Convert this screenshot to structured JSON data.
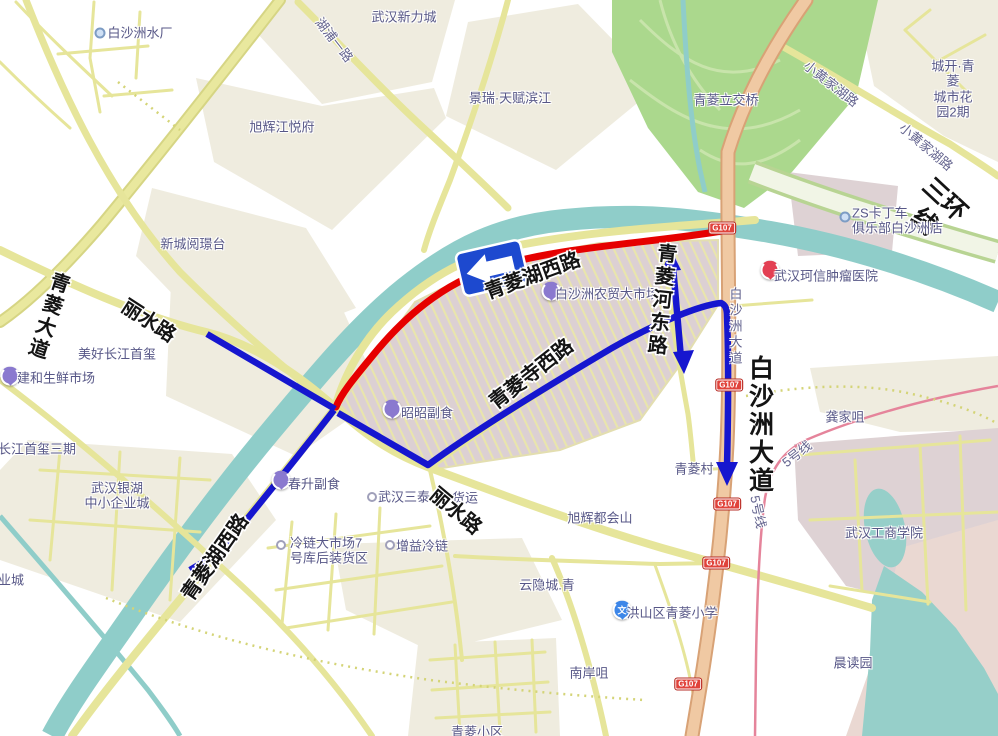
{
  "map": {
    "colors": {
      "closed_route": "#e60000",
      "detour_route": "#1616cf",
      "sign_blue": "#1d49cf"
    },
    "sign": {
      "kind": "detour-left-arrow"
    },
    "shields": [
      {
        "t": "G107",
        "x": 722,
        "y": 228
      },
      {
        "t": "G107",
        "x": 729,
        "y": 385
      },
      {
        "t": "G107",
        "x": 727,
        "y": 504
      },
      {
        "t": "G107",
        "x": 716,
        "y": 563
      },
      {
        "t": "G107",
        "x": 688,
        "y": 684
      }
    ],
    "markers": [
      {
        "type": "dot",
        "x": 100,
        "y": 33
      },
      {
        "type": "dot",
        "x": 845,
        "y": 217
      },
      {
        "type": "pin-red",
        "x": 770,
        "y": 272
      },
      {
        "type": "pin-purple",
        "x": 551,
        "y": 293
      },
      {
        "type": "pin-purple",
        "x": 10,
        "y": 378
      },
      {
        "type": "pin-purple",
        "x": 392,
        "y": 411
      },
      {
        "type": "pin-purple",
        "x": 281,
        "y": 482
      },
      {
        "type": "pin-school",
        "x": 622,
        "y": 612,
        "glyph": "文"
      },
      {
        "type": "ring",
        "x": 372,
        "y": 497
      },
      {
        "type": "ring",
        "x": 281,
        "y": 545
      },
      {
        "type": "ring",
        "x": 390,
        "y": 545
      }
    ],
    "labels": [
      {
        "t": "白沙洲水厂",
        "x": 140,
        "y": 33
      },
      {
        "t": "武汉新力城",
        "x": 404,
        "y": 17
      },
      {
        "t": "湖浦一路",
        "x": 334,
        "y": 40,
        "cls": "rp",
        "rot": 52
      },
      {
        "t": "景瑞·天赋滨江",
        "x": 510,
        "y": 98
      },
      {
        "t": "旭辉江悦府",
        "x": 282,
        "y": 127
      },
      {
        "t": "新城阅璟台",
        "x": 193,
        "y": 244
      },
      {
        "t": "青菱立交桥",
        "x": 726,
        "y": 100
      },
      {
        "t": "小黄家湖路",
        "x": 831,
        "y": 84,
        "cls": "rp",
        "rot": 38
      },
      {
        "t": "小黄家湖路",
        "x": 926,
        "y": 147,
        "cls": "rp",
        "rot": 40
      },
      {
        "t": "城开·青菱\n城市花园2期",
        "x": 953,
        "y": 89
      },
      {
        "t": "三环线",
        "x": 934,
        "y": 211,
        "cls": "rb26",
        "rot": 43
      },
      {
        "t": "ZS卡丁车\n俱乐部白沙洲店",
        "x": 852,
        "y": 221,
        "align": "left"
      },
      {
        "t": "武汉珂信肿瘤医院",
        "x": 826,
        "y": 276
      },
      {
        "t": "白沙洲农贸大市场",
        "x": 607,
        "y": 294
      },
      {
        "t": "白沙洲大道",
        "x": 735,
        "y": 327,
        "cls": "rp",
        "v": true
      },
      {
        "t": "美好长江首玺",
        "x": 117,
        "y": 354
      },
      {
        "t": "建和生鲜市场",
        "x": 56,
        "y": 378
      },
      {
        "t": "长江首玺三期",
        "x": 37,
        "y": 449
      },
      {
        "t": "昭昭副食",
        "x": 427,
        "y": 413
      },
      {
        "t": "武汉银湖\n中小企业城",
        "x": 117,
        "y": 496
      },
      {
        "t": "春升副食",
        "x": 314,
        "y": 484
      },
      {
        "t": "武汉三泰",
        "x": 404,
        "y": 497
      },
      {
        "t": "货运",
        "x": 465,
        "y": 498
      },
      {
        "t": "旭辉都会山",
        "x": 600,
        "y": 518
      },
      {
        "t": "冷链大市场7\n号库后装货区",
        "x": 290,
        "y": 551,
        "align": "left"
      },
      {
        "t": "增益冷链",
        "x": 422,
        "y": 546
      },
      {
        "t": "青菱村",
        "x": 694,
        "y": 469
      },
      {
        "t": "龚家咀",
        "x": 845,
        "y": 417
      },
      {
        "t": "5号线",
        "x": 797,
        "y": 454,
        "cls": "rp",
        "rot": -38
      },
      {
        "t": "5号线",
        "x": 758,
        "y": 512,
        "cls": "rp",
        "rot": 78
      },
      {
        "t": "武汉工商学院",
        "x": 884,
        "y": 533
      },
      {
        "t": "云隐城.青",
        "x": 547,
        "y": 585
      },
      {
        "t": "洪山区青菱小学",
        "x": 672,
        "y": 613
      },
      {
        "t": "南岸咀",
        "x": 589,
        "y": 673
      },
      {
        "t": "晨读园",
        "x": 853,
        "y": 663
      },
      {
        "t": "青菱小区",
        "x": 477,
        "y": 732
      },
      {
        "t": "业城",
        "x": -2,
        "y": 580,
        "align": "left"
      },
      {
        "t": "青菱湖西路",
        "x": 533,
        "y": 277,
        "cls": "rb",
        "rot": -20
      },
      {
        "t": "青菱河东路",
        "x": 660,
        "y": 300,
        "cls": "rb",
        "v": true,
        "rot": 6
      },
      {
        "t": "白沙洲大道",
        "x": 759,
        "y": 425,
        "cls": "rb26",
        "v": true
      },
      {
        "t": "丽水路",
        "x": 148,
        "y": 322,
        "cls": "rb",
        "rot": 33
      },
      {
        "t": "青菱大道",
        "x": 47,
        "y": 316,
        "cls": "rb",
        "v": true,
        "rot": 18
      },
      {
        "t": "青菱寺西路",
        "x": 532,
        "y": 375,
        "cls": "rb",
        "rot": -38
      },
      {
        "t": "丽水路",
        "x": 455,
        "y": 512,
        "cls": "rb",
        "rot": 40
      },
      {
        "t": "青菱湖西路",
        "x": 216,
        "y": 558,
        "cls": "rb",
        "rot": -55
      }
    ]
  }
}
